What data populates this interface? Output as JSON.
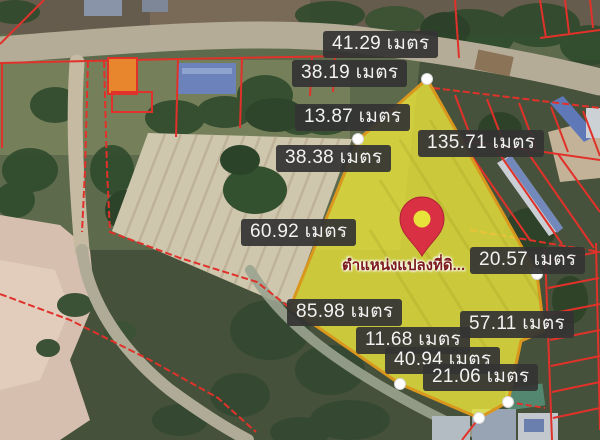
{
  "unit": "เมตร",
  "labels": [
    {
      "text": "41.29 เมตร",
      "value": 41.29
    },
    {
      "text": "38.19 เมตร",
      "value": 38.19
    },
    {
      "text": "13.87 เมตร",
      "value": 13.87
    },
    {
      "text": "38.38 เมตร",
      "value": 38.38
    },
    {
      "text": "135.71 เมตร",
      "value": 135.71
    },
    {
      "text": "60.92 เมตร",
      "value": 60.92
    },
    {
      "text": "20.57 เมตร",
      "value": 20.57
    },
    {
      "text": "85.98 เมตร",
      "value": 85.98
    },
    {
      "text": "57.11 เมตร",
      "value": 57.11
    },
    {
      "text": "11.68 เมตร",
      "value": 11.68
    },
    {
      "text": "40.94 เมตร",
      "value": 40.94
    },
    {
      "text": "21.06 เมตร",
      "value": 21.06
    }
  ],
  "pin": {
    "caption": "ตำแหน่งแปลงที่ดิ...",
    "icon": "map-pin-icon",
    "color": "#d93043"
  },
  "parcel": {
    "highlight_fill": "#ece73c",
    "border_color": "#d9971e",
    "vertex_marker": "white-dot"
  },
  "map_colors": {
    "cadastral_line": "#e0322a",
    "label_bg": "#343434",
    "label_text": "#f2f2f2",
    "pin_caption_text": "#7c1b1b"
  }
}
